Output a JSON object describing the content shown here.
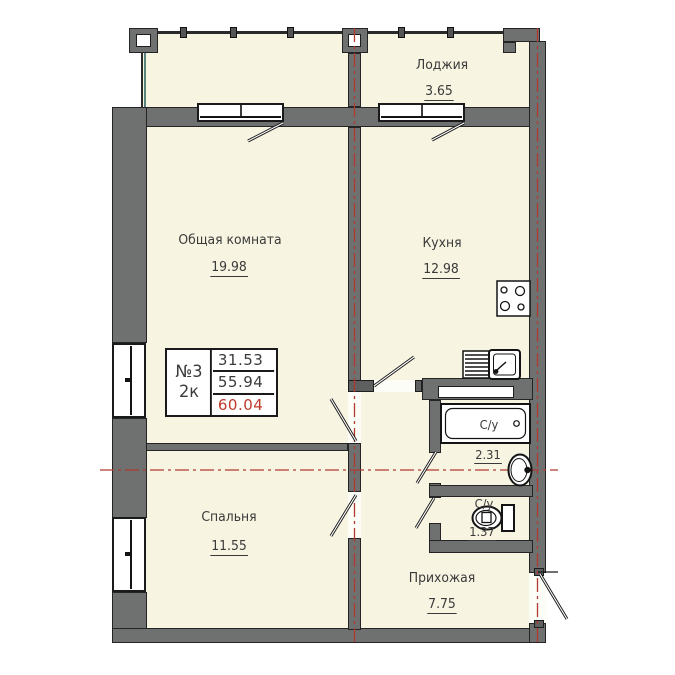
{
  "plan": {
    "title": "apartment-floor-plan",
    "rooms": {
      "loggia": {
        "name": "Лоджия",
        "area": "3.65"
      },
      "living": {
        "name": "Общая комната",
        "area": "19.98"
      },
      "kitchen": {
        "name": "Кухня",
        "area": "12.98"
      },
      "bedroom": {
        "name": "Спальня",
        "area": "11.55"
      },
      "hallway": {
        "name": "Прихожая",
        "area": "7.75"
      },
      "bathroom": {
        "name": "С/у",
        "area": "2.31"
      },
      "wc": {
        "name": "С/у",
        "area": "1.37"
      }
    },
    "info_box": {
      "apartment_number": "№3",
      "rooms_type": "2к",
      "living_area": "31.53",
      "area_without_loggia": "55.94",
      "total_area": "60.04"
    }
  },
  "colors": {
    "floor_fill": "#f7f4e1",
    "wall_gray": "#6f7070",
    "outline_black": "#1a1a1a",
    "axis_red": "#b03a30",
    "accent_teal": "#5a837d",
    "total_area_red": "#c0392b"
  }
}
